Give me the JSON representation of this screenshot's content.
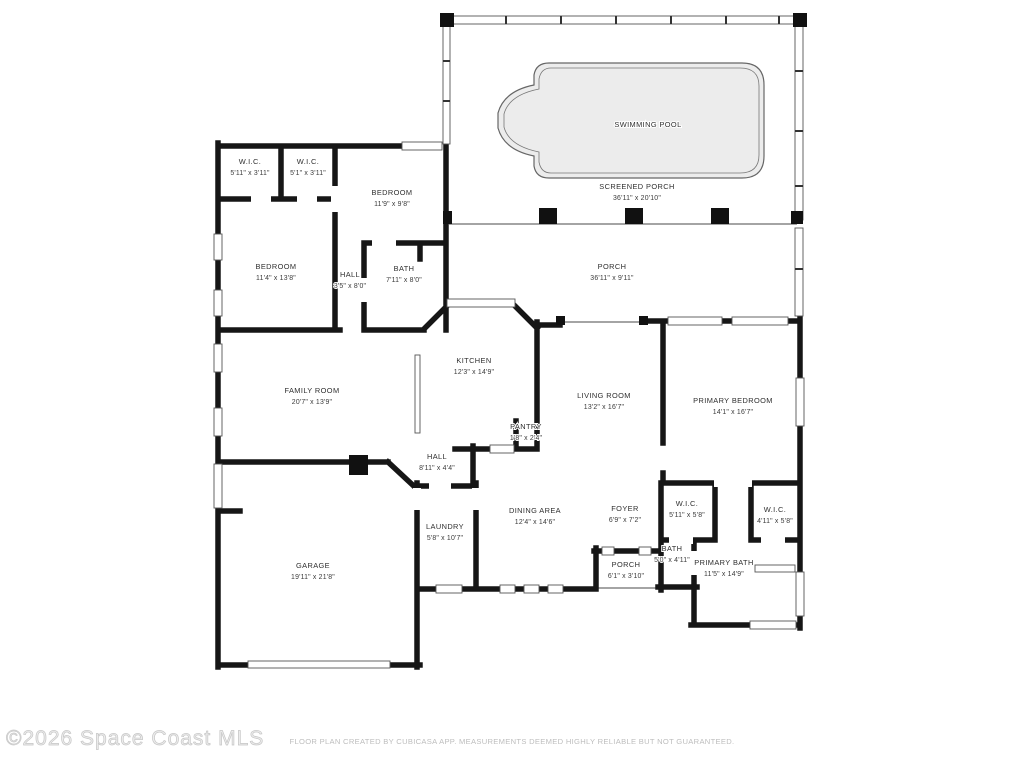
{
  "plan": {
    "watermark": "©2026 Space Coast MLS",
    "disclaimer": "FLOOR PLAN CREATED BY CUBICASA APP. MEASUREMENTS DEEMED HIGHLY RELIABLE BUT NOT GUARANTEED.",
    "colors": {
      "wall": "#161616",
      "pool_fill": "#ececec",
      "label_text": "#2f2f2f",
      "watermark_text": "#c6c6c6",
      "disclaimer_text": "#bdbdbd",
      "background": "#ffffff"
    },
    "rooms": [
      {
        "name": "SWIMMING POOL",
        "dims": ""
      },
      {
        "name": "SCREENED PORCH",
        "dims": "36'11\" x 20'10\""
      },
      {
        "name": "PORCH",
        "dims": "36'11\" x 9'11\""
      },
      {
        "name": "W.I.C.",
        "dims": "5'11\" x 3'11\""
      },
      {
        "name": "W.I.C.",
        "dims": "5'1\" x 3'11\""
      },
      {
        "name": "BEDROOM",
        "dims": "11'9\" x 9'8\""
      },
      {
        "name": "BEDROOM",
        "dims": "11'4\" x 13'8\""
      },
      {
        "name": "HALL",
        "dims": "3'5\" x 8'0\""
      },
      {
        "name": "BATH",
        "dims": "7'11\" x 8'0\""
      },
      {
        "name": "FAMILY ROOM",
        "dims": "20'7\" x 13'9\""
      },
      {
        "name": "KITCHEN",
        "dims": "12'3\" x 14'9\""
      },
      {
        "name": "LIVING ROOM",
        "dims": "13'2\" x 16'7\""
      },
      {
        "name": "PRIMARY BEDROOM",
        "dims": "14'1\" x 16'7\""
      },
      {
        "name": "PANTRY",
        "dims": "1'8\" x 2'4\""
      },
      {
        "name": "HALL",
        "dims": "8'11\" x 4'4\""
      },
      {
        "name": "DINING AREA",
        "dims": "12'4\" x 14'6\""
      },
      {
        "name": "FOYER",
        "dims": "6'9\" x 7'2\""
      },
      {
        "name": "W.I.C.",
        "dims": "5'11\" x 5'8\""
      },
      {
        "name": "W.I.C.",
        "dims": "4'11\" x 5'8\""
      },
      {
        "name": "LAUNDRY",
        "dims": "5'8\" x 10'7\""
      },
      {
        "name": "BATH",
        "dims": "5'0\" x 4'11\""
      },
      {
        "name": "PORCH",
        "dims": "6'1\" x 3'10\""
      },
      {
        "name": "PRIMARY BATH",
        "dims": "11'5\" x 14'9\""
      },
      {
        "name": "GARAGE",
        "dims": "19'11\" x 21'8\""
      }
    ]
  }
}
